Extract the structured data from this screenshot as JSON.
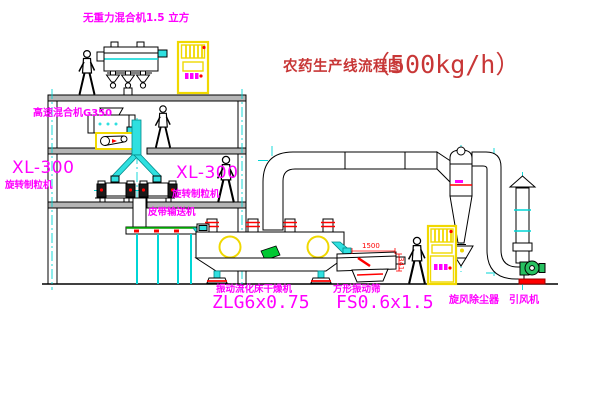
{
  "title": {
    "text": "农药生产线流程图",
    "capacity": "（500kg/h）"
  },
  "equipment": {
    "gravity_mixer": {
      "label": "无重力混合机1.5 立方"
    },
    "high_speed_mixer": {
      "label": "高速混合机G350"
    },
    "granulator_left": {
      "model": "XL-300",
      "name": "旋转制粒机"
    },
    "granulator_right": {
      "model": "XL-300",
      "name": "旋转制粒机"
    },
    "belt_conveyor": {
      "name": "皮带输送机"
    },
    "fluid_bed_dryer": {
      "name": "振动流化床干燥机",
      "model": "ZLG6x0.75"
    },
    "square_screen": {
      "name": "方形振动筛",
      "model": "FS0.6x1.5",
      "dim_width": "1500",
      "dim_height": "341"
    },
    "cyclone": {
      "name": "旋风除尘器"
    },
    "induced_draft_fan": {
      "name": "引风机"
    }
  },
  "colors": {
    "label_magenta": "#ff00ff",
    "title_red": "#c83737",
    "line_black": "#000000",
    "centerline_cyan": "#00d5d5",
    "highlight_yellow": "#f0d800",
    "accent_red": "#ff0000",
    "accent_green": "#00b050",
    "slab_gray": "#b5b5b5"
  }
}
